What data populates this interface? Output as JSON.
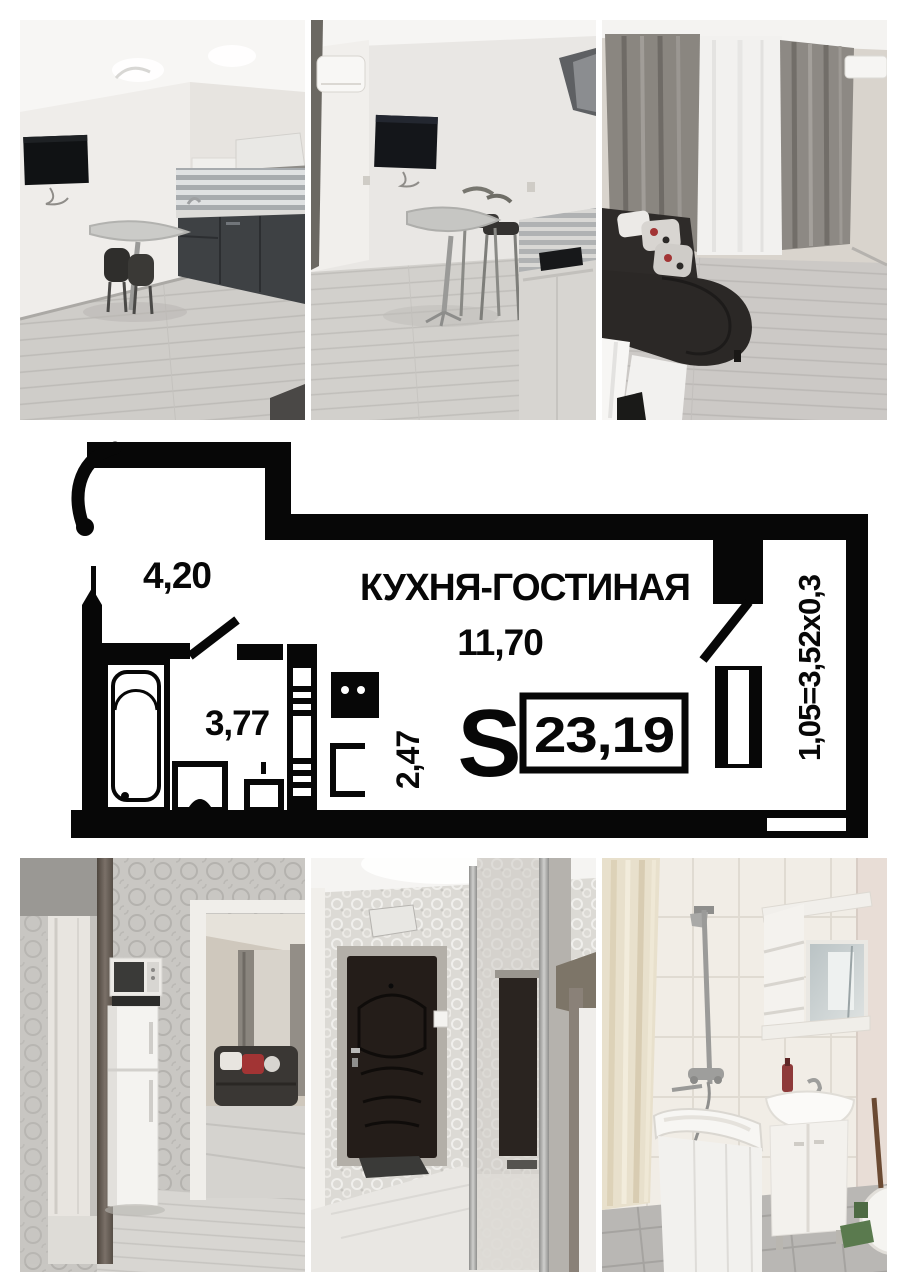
{
  "collage": {
    "background": "#ffffff",
    "floor_plan": {
      "title": "КУХНЯ-ГОСТИНАЯ",
      "main_room_area": "11,70",
      "hall_area": "4,20",
      "bathroom_area": "3,77",
      "corridor_area": "2,47",
      "area_symbol": "S",
      "total_area": "23,19",
      "balcony_dimensions": "1,05=3,52х0,3",
      "wall_color": "#070707",
      "paper_color": "#ffffff"
    },
    "photos": {
      "top": [
        {
          "id": "kitchen-dining-view"
        },
        {
          "id": "dining-area-view"
        },
        {
          "id": "living-room-view"
        }
      ],
      "bottom": [
        {
          "id": "hallway-fridge-view"
        },
        {
          "id": "entrance-hall-view"
        },
        {
          "id": "bathroom-view"
        }
      ]
    }
  }
}
